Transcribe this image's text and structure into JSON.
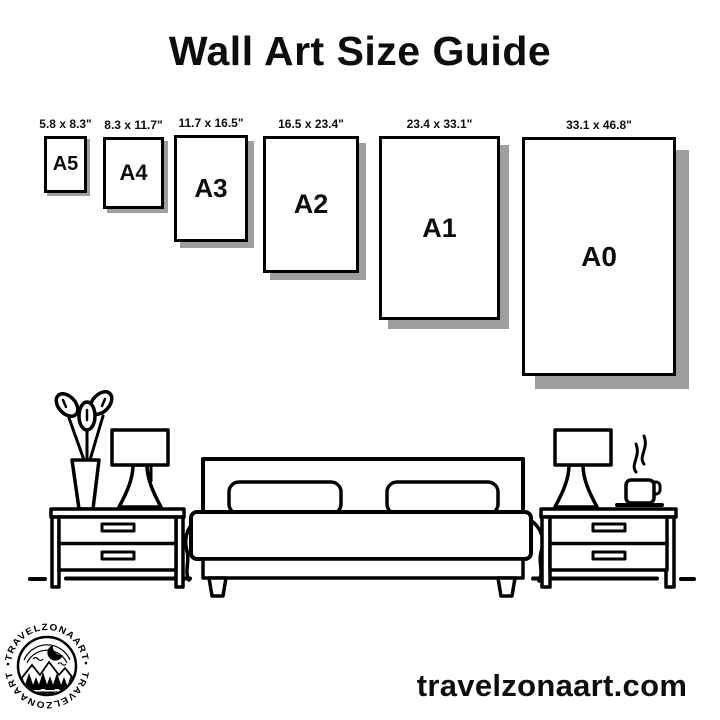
{
  "title": "Wall Art Size Guide",
  "website": "travelzonaart.com",
  "logo": {
    "brand_top": "•TRAVELZONAART•",
    "brand_bottom": "TRAVELZONAART"
  },
  "colors": {
    "ink": "#000000",
    "shadow": "#9e9e9e",
    "paper": "#ffffff"
  },
  "sizes": [
    {
      "name": "A5",
      "dimensions": "5.8 x 8.3\""
    },
    {
      "name": "A4",
      "dimensions": "8.3 x 11.7\""
    },
    {
      "name": "A3",
      "dimensions": "11.7 x 16.5\""
    },
    {
      "name": "A2",
      "dimensions": "16.5 x 23.4\""
    },
    {
      "name": "A1",
      "dimensions": "23.4 x 33.1\""
    },
    {
      "name": "A0",
      "dimensions": "33.1 x 46.8\""
    }
  ]
}
